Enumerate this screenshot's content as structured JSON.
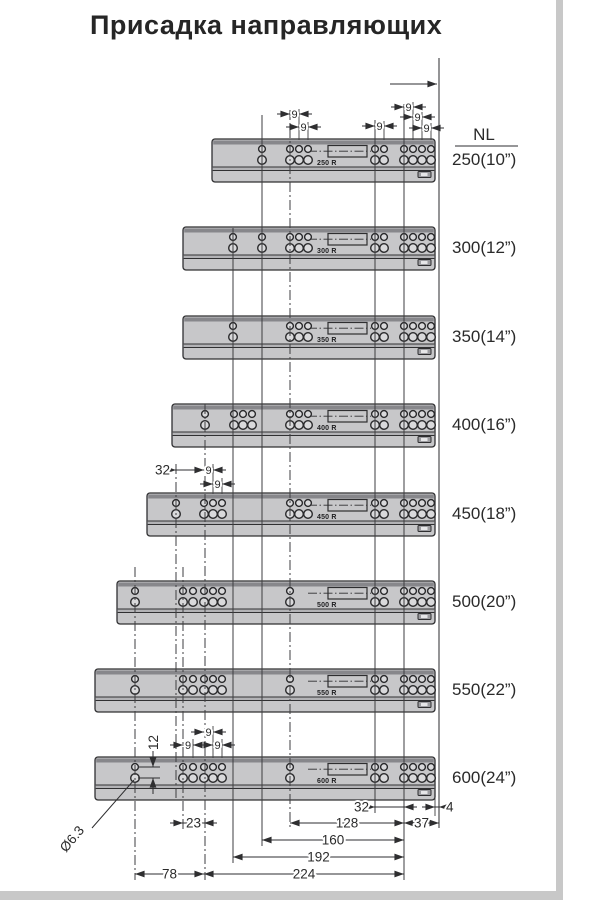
{
  "title": "Присадка направляющих",
  "table_header": "NL",
  "colors": {
    "rail_fill": "#c7c7c9",
    "rail_top_band": "#87878b",
    "outline": "#303032",
    "dim_text": "#2b2b2b",
    "edge_bar": "#c8c8c8"
  },
  "diagram": {
    "rail_right": 435,
    "rail_height": 43,
    "datum_arrow": {
      "x1": 390,
      "x2": 437,
      "y": 84
    },
    "rails": [
      {
        "size": "250",
        "label": "250(10”)",
        "print": "250 R",
        "y": 139,
        "left": 212,
        "cols": [
          [
            262
          ],
          [
            290,
            299,
            308
          ],
          [
            375,
            384
          ],
          [
            404,
            413,
            422,
            431
          ]
        ]
      },
      {
        "size": "300",
        "label": "300(12”)",
        "print": "300 R",
        "y": 227,
        "left": 183,
        "cols": [
          [
            233
          ],
          [
            262
          ],
          [
            290,
            299,
            308
          ],
          [
            375,
            384
          ],
          [
            404,
            413,
            422,
            431
          ]
        ]
      },
      {
        "size": "350",
        "label": "350(14”)",
        "print": "350 R",
        "y": 316,
        "left": 183,
        "cols": [
          [
            233
          ],
          [
            290,
            299,
            308
          ],
          [
            375,
            384
          ],
          [
            404,
            413,
            422,
            431
          ]
        ]
      },
      {
        "size": "400",
        "label": "400(16”)",
        "print": "400 R",
        "y": 404,
        "left": 172,
        "cols": [
          [
            205
          ],
          [
            234,
            243,
            252
          ],
          [
            290,
            299,
            308
          ],
          [
            375,
            384
          ],
          [
            404,
            413,
            422,
            431
          ]
        ]
      },
      {
        "size": "450",
        "label": "450(18”)",
        "print": "450 R",
        "y": 493,
        "left": 147,
        "cols": [
          [
            176
          ],
          [
            204,
            213,
            222
          ],
          [
            290,
            299,
            308
          ],
          [
            375,
            384
          ],
          [
            404,
            413,
            422,
            431
          ]
        ]
      },
      {
        "size": "500",
        "label": "500(20”)",
        "print": "500 R",
        "y": 581,
        "left": 117,
        "cols": [
          [
            135
          ],
          [
            183,
            193
          ],
          [
            204,
            213,
            222
          ],
          [
            290
          ],
          [
            375,
            384
          ],
          [
            404,
            413,
            422,
            431
          ]
        ]
      },
      {
        "size": "550",
        "label": "550(22”)",
        "print": "550 R",
        "y": 669,
        "left": 95,
        "cols": [
          [
            135
          ],
          [
            183,
            193
          ],
          [
            204,
            213,
            222
          ],
          [
            290
          ],
          [
            375,
            384
          ],
          [
            404,
            413,
            422,
            431
          ]
        ]
      },
      {
        "size": "600",
        "label": "600(24”)",
        "print": "600 R",
        "y": 757,
        "left": 95,
        "cols": [
          [
            135
          ],
          [
            183,
            193
          ],
          [
            204,
            213,
            222
          ],
          [
            290
          ],
          [
            375,
            384
          ],
          [
            404,
            413,
            422,
            431
          ]
        ]
      }
    ],
    "vlines": [
      {
        "x": 439,
        "y1": 58,
        "y2": 828,
        "style": "solid",
        "w": 1.1
      },
      {
        "x": 404,
        "y1": 104,
        "y2": 880,
        "style": "solid",
        "w": 1
      },
      {
        "x": 375,
        "y1": 120,
        "y2": 813,
        "style": "solid",
        "w": 1
      },
      {
        "x": 262,
        "y1": 115,
        "y2": 846,
        "style": "solid",
        "w": 1
      },
      {
        "x": 233,
        "y1": 228,
        "y2": 863,
        "style": "solid",
        "w": 1
      },
      {
        "x": 290,
        "y1": 110,
        "y2": 829,
        "style": "dashdot",
        "w": 1
      },
      {
        "x": 205,
        "y1": 404,
        "y2": 880,
        "style": "dashdot",
        "w": 1
      },
      {
        "x": 176,
        "y1": 464,
        "y2": 800,
        "style": "dashdot",
        "w": 1
      },
      {
        "x": 183,
        "y1": 567,
        "y2": 830,
        "style": "dashdot",
        "w": 1
      },
      {
        "x": 135,
        "y1": 567,
        "y2": 880,
        "style": "dashdot",
        "w": 1
      },
      {
        "x": 435,
        "y1": 798,
        "y2": 816,
        "style": "solid",
        "w": 0.9
      },
      {
        "x": 299,
        "y1": 109,
        "y2": 140,
        "style": "solid",
        "w": 0.9
      },
      {
        "x": 308,
        "y1": 122,
        "y2": 140,
        "style": "solid",
        "w": 0.9
      },
      {
        "x": 384,
        "y1": 121,
        "y2": 140,
        "style": "solid",
        "w": 0.9
      },
      {
        "x": 413,
        "y1": 102,
        "y2": 140,
        "style": "solid",
        "w": 0.9
      },
      {
        "x": 422,
        "y1": 112,
        "y2": 140,
        "style": "solid",
        "w": 0.9
      },
      {
        "x": 431,
        "y1": 123,
        "y2": 140,
        "style": "solid",
        "w": 0.9
      },
      {
        "x": 213,
        "y1": 464,
        "y2": 494,
        "style": "solid",
        "w": 0.9
      },
      {
        "x": 222,
        "y1": 478,
        "y2": 494,
        "style": "solid",
        "w": 0.9
      },
      {
        "x": 193,
        "y1": 739,
        "y2": 758,
        "style": "solid",
        "w": 0.9
      },
      {
        "x": 213,
        "y1": 726,
        "y2": 758,
        "style": "solid",
        "w": 0.9
      },
      {
        "x": 222,
        "y1": 739,
        "y2": 758,
        "style": "solid",
        "w": 0.9
      }
    ],
    "hdims": [
      {
        "x1": 290,
        "x2": 299,
        "y": 114,
        "label": "9",
        "arrows": "out",
        "text": "center",
        "small": true
      },
      {
        "x1": 299,
        "x2": 308,
        "y": 127,
        "label": "9",
        "arrows": "out",
        "text": "center",
        "small": true
      },
      {
        "x1": 375,
        "x2": 384,
        "y": 126,
        "label": "9",
        "arrows": "out",
        "text": "center",
        "small": true
      },
      {
        "x1": 404,
        "x2": 413,
        "y": 107,
        "label": "9",
        "arrows": "out",
        "text": "center",
        "small": true
      },
      {
        "x1": 413,
        "x2": 422,
        "y": 117,
        "label": "9",
        "arrows": "out",
        "text": "center",
        "small": true
      },
      {
        "x1": 422,
        "x2": 431,
        "y": 128,
        "label": "9",
        "arrows": "out",
        "text": "center",
        "small": true
      },
      {
        "x1": 176,
        "x2": 204,
        "y": 470,
        "label": "32",
        "arrows": "out",
        "text": "left"
      },
      {
        "x1": 204,
        "x2": 213,
        "y": 470,
        "label": "9",
        "arrows": "out",
        "text": "center",
        "small": true
      },
      {
        "x1": 213,
        "x2": 222,
        "y": 484,
        "label": "9",
        "arrows": "out",
        "text": "center",
        "small": true
      },
      {
        "x1": 204,
        "x2": 213,
        "y": 732,
        "label": "9",
        "arrows": "out",
        "text": "center",
        "small": true
      },
      {
        "x1": 183,
        "x2": 193,
        "y": 745,
        "label": "9",
        "arrows": "out",
        "text": "center",
        "small": true
      },
      {
        "x1": 213,
        "x2": 222,
        "y": 745,
        "label": "9",
        "arrows": "out",
        "text": "center",
        "small": true
      },
      {
        "x1": 375,
        "x2": 404,
        "y": 807,
        "label": "32",
        "arrows": "out",
        "text": "left"
      },
      {
        "x1": 435,
        "x2": 439,
        "y": 807,
        "label": "4",
        "arrows": "out",
        "text": "right"
      },
      {
        "x1": 183,
        "x2": 204,
        "y": 823,
        "label": "23",
        "arrows": "out",
        "text": "center"
      },
      {
        "x1": 290,
        "x2": 404,
        "y": 823,
        "label": "128",
        "arrows": "in",
        "text": "center"
      },
      {
        "x1": 404,
        "x2": 439,
        "y": 823,
        "label": "37",
        "arrows": "in",
        "text": "center"
      },
      {
        "x1": 262,
        "x2": 404,
        "y": 840,
        "label": "160",
        "arrows": "in",
        "text": "center"
      },
      {
        "x1": 233,
        "x2": 404,
        "y": 857,
        "label": "192",
        "arrows": "in",
        "text": "center"
      },
      {
        "x1": 135,
        "x2": 204,
        "y": 874,
        "label": "78",
        "arrows": "in",
        "text": "center"
      },
      {
        "x1": 204,
        "x2": 404,
        "y": 874,
        "label": "224",
        "arrows": "in",
        "text": "center"
      }
    ],
    "vdim": {
      "label": "12",
      "x": 153,
      "yTop": 767,
      "yBot": 778,
      "extX1": 138,
      "extX2": 160,
      "textX": 158,
      "textY": 750
    },
    "hole_note": {
      "label": "Ø6.3",
      "tx": 66,
      "ty": 853,
      "rot": -50,
      "leader": [
        92,
        828,
        134,
        780
      ]
    }
  }
}
